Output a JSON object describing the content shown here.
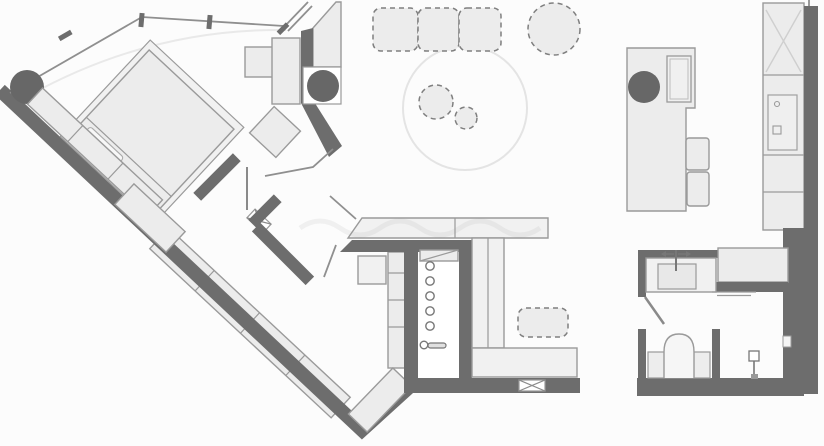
{
  "canvas": {
    "width": 824,
    "height": 446,
    "background": "#fcfcfc"
  },
  "colors": {
    "bg": "#fcfcfc",
    "wall": "#6d6d6d",
    "column": "#676767",
    "furniture_fill": "#ececec",
    "furniture_fill_light": "#f1f1f1",
    "furniture_stroke": "#9a9a9a",
    "line": "#8f8f8f",
    "faint_line": "#e4e4e4",
    "dash": "#7f7f7f",
    "white": "#ffffff",
    "watermark": "#9a9a9a"
  }
}
